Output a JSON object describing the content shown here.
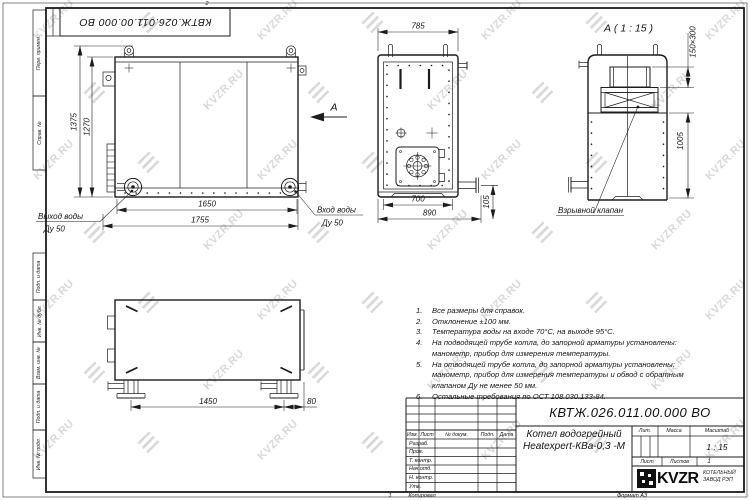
{
  "watermark": {
    "text": "KVZR.RU"
  },
  "frame": {
    "zone_top": "2"
  },
  "top_stamp": {
    "doc_number": "КВТЖ.026.011.00.000 ВО"
  },
  "views": {
    "view_arrow_label": "А",
    "front": {
      "dim_height_outer": "1375",
      "dim_height_inner": "1270",
      "dim_width_inner": "1650",
      "dim_width_outer": "1755",
      "outlet_line1": "Выход воды",
      "outlet_line2": "Ду 50",
      "inlet_line1": "Вход воды",
      "inlet_line2": "Ду 50"
    },
    "side": {
      "dim_top": "785",
      "dim_bottom_inner": "700",
      "dim_bottom_outer": "890",
      "dim_pipe": "105"
    },
    "a_view": {
      "title": "А ( 1 : 15 )",
      "dim_valve": "150×300",
      "dim_height": "1005",
      "valve_label": "Взрывной клапан"
    },
    "bottom": {
      "dim_legs": "1450",
      "dim_edge": "80"
    }
  },
  "notes": [
    {
      "n": "1.",
      "t": "Все размеры для справок."
    },
    {
      "n": "2.",
      "t": "Отклонение ±100 мм."
    },
    {
      "n": "3.",
      "t": "Температура воды на входе 70°С, на выходе 95°С."
    },
    {
      "n": "4.",
      "t": "На подводящей трубе котла, до запорной арматуры установлены:"
    },
    {
      "n": "",
      "t": "манометр, прибор для измерения температуры."
    },
    {
      "n": "5.",
      "t": "На отводящей трубе котла, до запорной арматуры установлены:"
    },
    {
      "n": "",
      "t": "манометр, прибор для измерения температуры и обвод с обратным"
    },
    {
      "n": "",
      "t": "клапаном Ду не менее 50 мм."
    },
    {
      "n": "6.",
      "t": "Остальные требования по ОСТ 108.030.133-84."
    }
  ],
  "title_block": {
    "doc_number": "КВТЖ.026.011.00.000 ВО",
    "product_name_line1": "Котел водогрейный",
    "product_name_line2": "Heatexpert-КВа-0,3 -М",
    "col_izm": "Изм.",
    "col_list": "Лист",
    "col_docnum": "№ докум.",
    "col_podp": "Подп.",
    "col_data": "Дата",
    "row_razrab": "Разраб.",
    "row_prov": "Пров.",
    "row_tkontr": "Т. контр.",
    "row_nachotd": "Нач.отд.",
    "row_nkontr": "Н. контр.",
    "row_utv": "Утв.",
    "lit_label": "Лит.",
    "mass_label": "Масса",
    "scale_label": "Масштаб",
    "scale_value": "1 : 15",
    "sheet_label": "Лист",
    "sheets_label": "Листов",
    "sheets_value": "1",
    "logo_text": "KVZR",
    "logo_sub_line1": "КОТЕЛЬНЫЙ",
    "logo_sub_line2": "ЗАВОД РЭП",
    "page_num": "1",
    "copied_label": "Копировал",
    "format_label": "Формат А3"
  },
  "margin_labels": [
    "Перв. примен.",
    "Справ. №",
    "Подп. и дата",
    "Инв. № дубл.",
    "Взам. инв. №",
    "Подп. и дата",
    "Инв. № подл."
  ]
}
